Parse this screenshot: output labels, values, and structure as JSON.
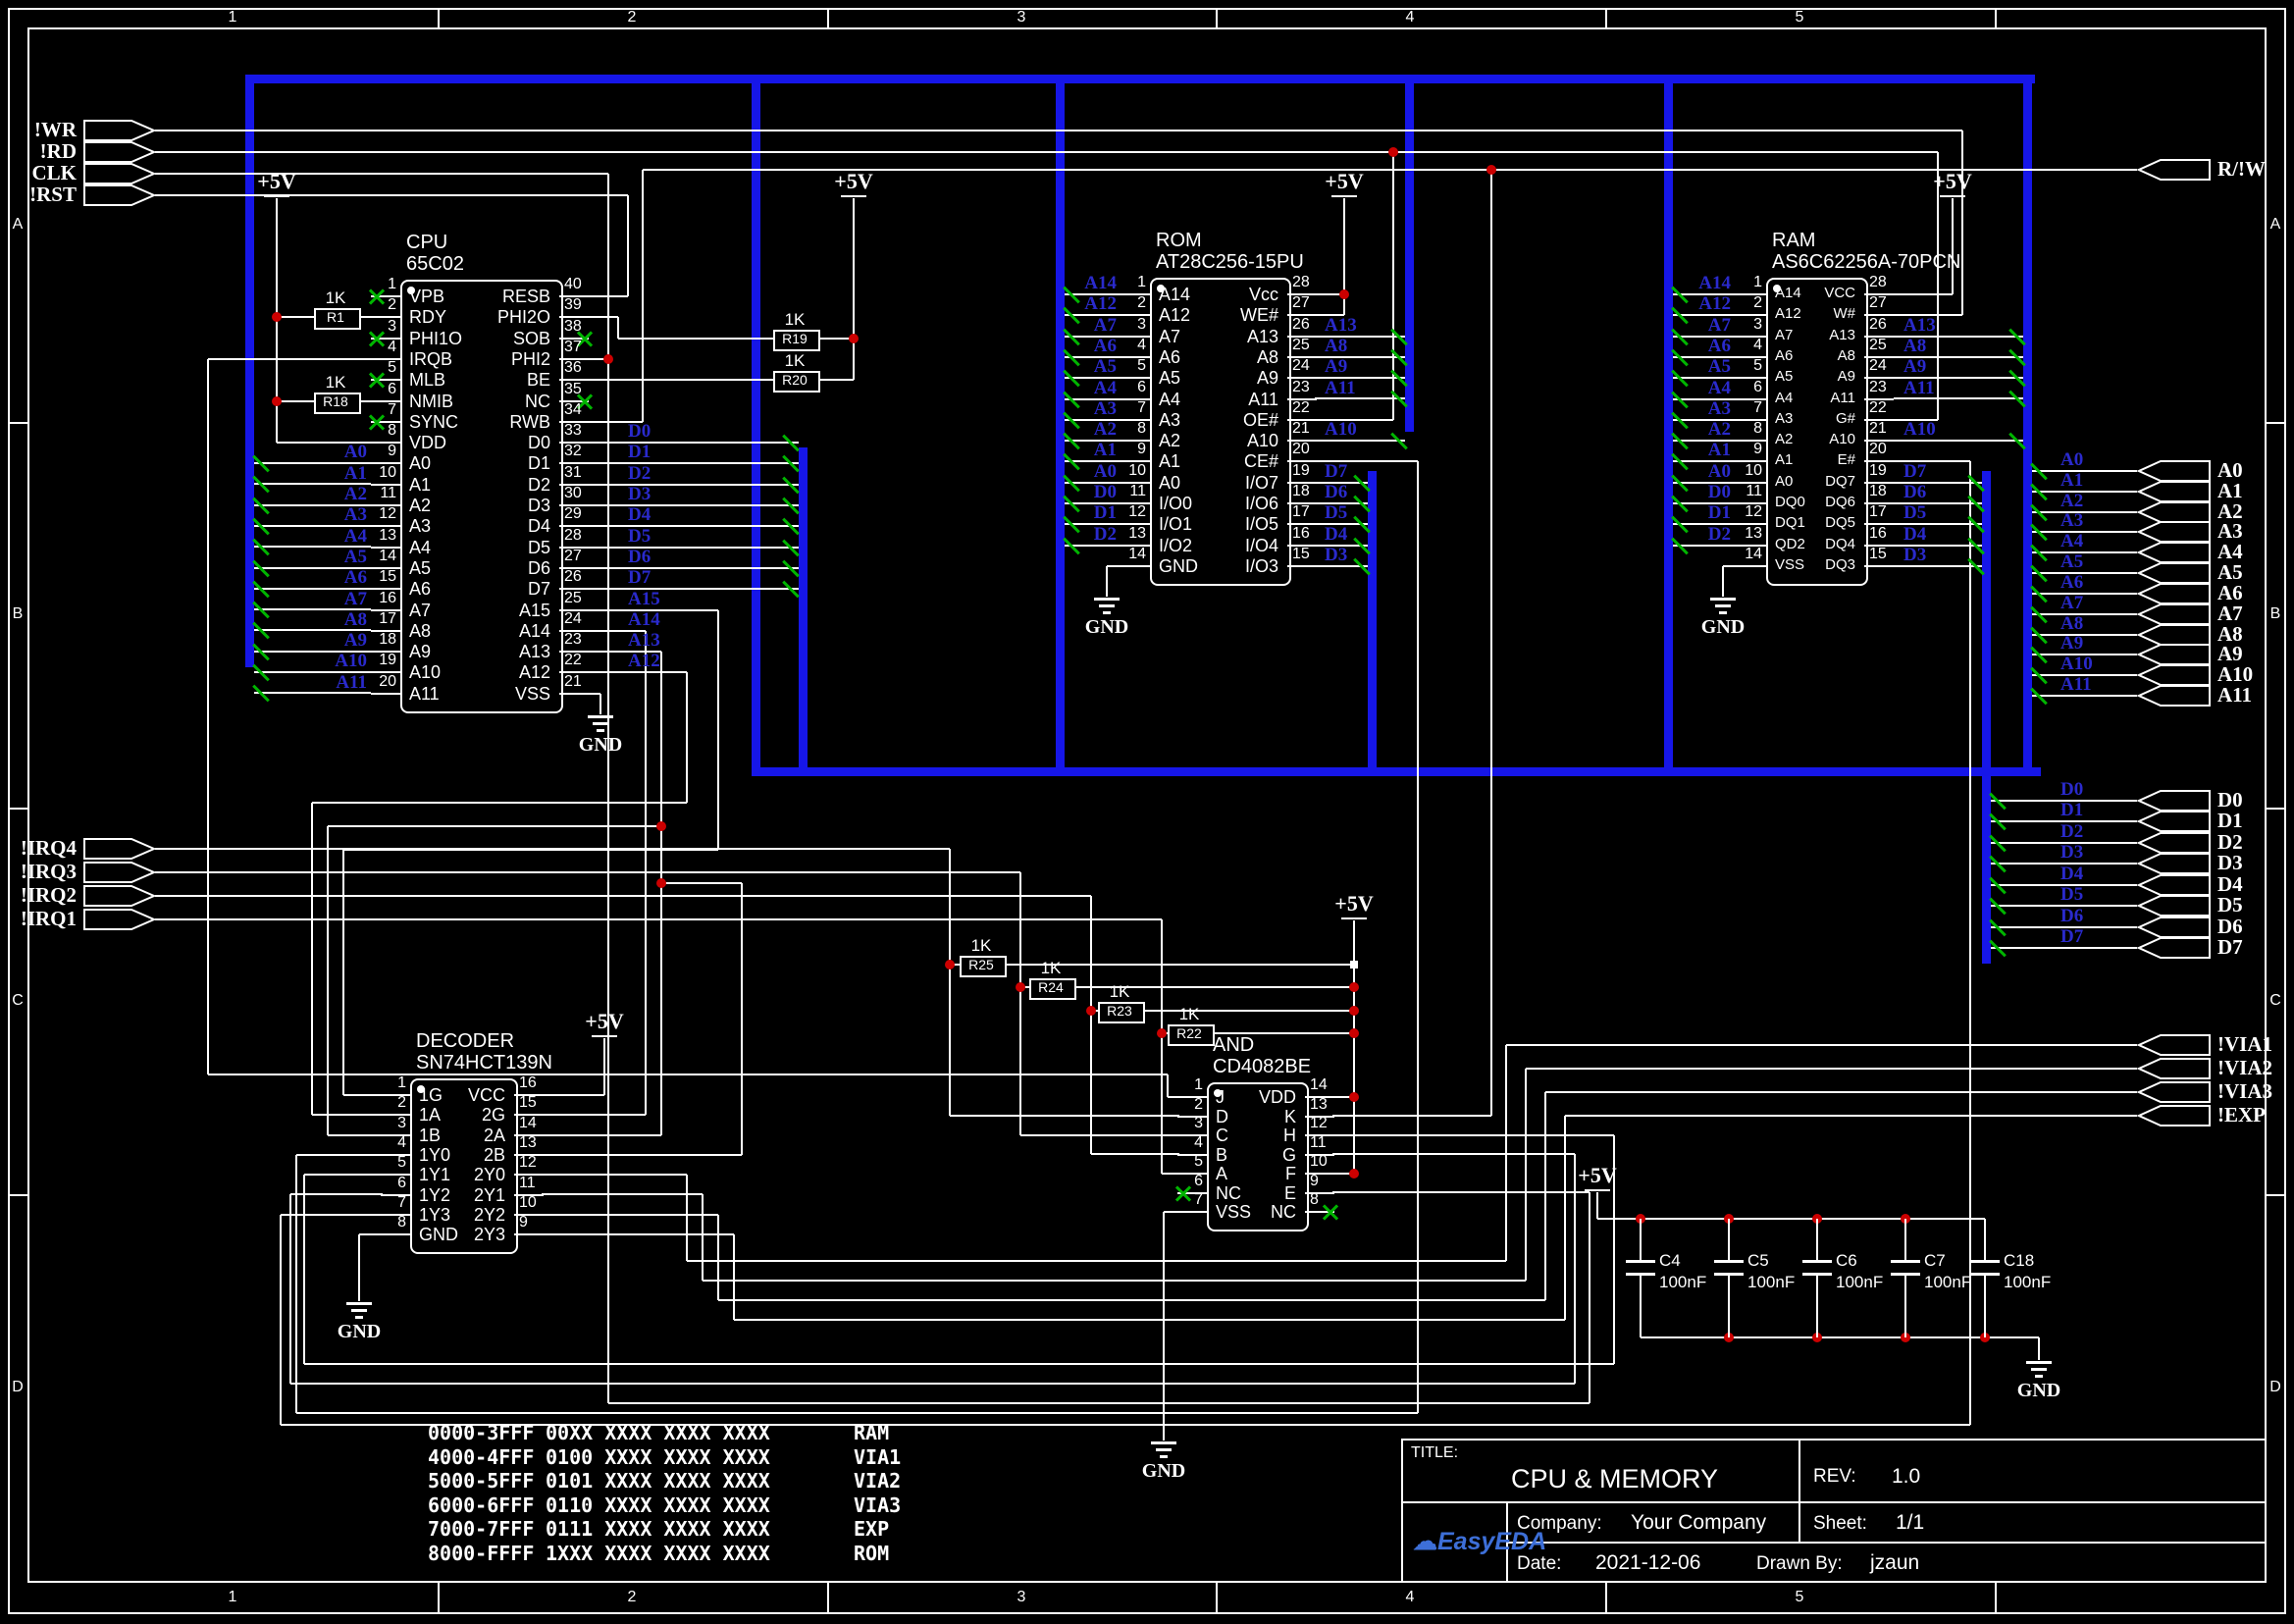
{
  "colors": {
    "bus": "#1616E8",
    "net_label": "#2A2ACC",
    "wire": "#FFFFFF",
    "nc": "#00B400",
    "junction": "#CC0000",
    "logo_blue": "#3D6FD8",
    "background": "#000000"
  },
  "power_labels": {
    "vcc": "+5V",
    "gnd": "GND"
  },
  "ruler": {
    "columns": [
      "1",
      "2",
      "3",
      "4",
      "5"
    ],
    "rows": [
      "A",
      "B",
      "C",
      "D"
    ]
  },
  "ports": {
    "left_top": [
      "!WR",
      "!RD",
      "CLK",
      "!RST"
    ],
    "left_irq": [
      "!IRQ4",
      "!IRQ3",
      "!IRQ2",
      "!IRQ1"
    ],
    "right_rw": "R/!W",
    "right_addr": [
      "A0",
      "A1",
      "A2",
      "A3",
      "A4",
      "A5",
      "A6",
      "A7",
      "A8",
      "A9",
      "A10",
      "A11"
    ],
    "right_data": [
      "D0",
      "D1",
      "D2",
      "D3",
      "D4",
      "D5",
      "D6",
      "D7"
    ],
    "right_sel": [
      "!VIA1",
      "!VIA2",
      "!VIA3",
      "!EXP"
    ]
  },
  "components": {
    "cpu": {
      "ref": "CPU",
      "value": "65C02",
      "left_pins": [
        {
          "num": "1",
          "name": "VPB",
          "nc": true
        },
        {
          "num": "2",
          "name": "RDY"
        },
        {
          "num": "3",
          "name": "PHI1O",
          "nc": true
        },
        {
          "num": "4",
          "name": "IRQB"
        },
        {
          "num": "5",
          "name": "MLB",
          "nc": true
        },
        {
          "num": "6",
          "name": "NMIB"
        },
        {
          "num": "7",
          "name": "SYNC",
          "nc": true
        },
        {
          "num": "8",
          "name": "VDD"
        },
        {
          "num": "9",
          "name": "A0",
          "label": "A0"
        },
        {
          "num": "10",
          "name": "A1",
          "label": "A1"
        },
        {
          "num": "11",
          "name": "A2",
          "label": "A2"
        },
        {
          "num": "12",
          "name": "A3",
          "label": "A3"
        },
        {
          "num": "13",
          "name": "A4",
          "label": "A4"
        },
        {
          "num": "14",
          "name": "A5",
          "label": "A5"
        },
        {
          "num": "15",
          "name": "A6",
          "label": "A6"
        },
        {
          "num": "16",
          "name": "A7",
          "label": "A7"
        },
        {
          "num": "17",
          "name": "A8",
          "label": "A8"
        },
        {
          "num": "18",
          "name": "A9",
          "label": "A9"
        },
        {
          "num": "19",
          "name": "A10",
          "label": "A10"
        },
        {
          "num": "20",
          "name": "A11",
          "label": "A11"
        }
      ],
      "right_pins": [
        {
          "num": "40",
          "name": "RESB"
        },
        {
          "num": "39",
          "name": "PHI2O"
        },
        {
          "num": "38",
          "name": "SOB",
          "nc": true
        },
        {
          "num": "37",
          "name": "PHI2"
        },
        {
          "num": "36",
          "name": "BE"
        },
        {
          "num": "35",
          "name": "NC",
          "nc": true
        },
        {
          "num": "34",
          "name": "RWB"
        },
        {
          "num": "33",
          "name": "D0",
          "label": "D0"
        },
        {
          "num": "32",
          "name": "D1",
          "label": "D1"
        },
        {
          "num": "31",
          "name": "D2",
          "label": "D2"
        },
        {
          "num": "30",
          "name": "D3",
          "label": "D3"
        },
        {
          "num": "29",
          "name": "D4",
          "label": "D4"
        },
        {
          "num": "28",
          "name": "D5",
          "label": "D5"
        },
        {
          "num": "27",
          "name": "D6",
          "label": "D6"
        },
        {
          "num": "26",
          "name": "D7",
          "label": "D7"
        },
        {
          "num": "25",
          "name": "A15",
          "label": "A15"
        },
        {
          "num": "24",
          "name": "A14",
          "label": "A14"
        },
        {
          "num": "23",
          "name": "A13",
          "label": "A13"
        },
        {
          "num": "22",
          "name": "A12",
          "label": "A12"
        },
        {
          "num": "21",
          "name": "VSS"
        }
      ]
    },
    "rom": {
      "ref": "ROM",
      "value": "AT28C256-15PU",
      "left_pins": [
        {
          "num": "1",
          "name": "A14",
          "label": "A14"
        },
        {
          "num": "2",
          "name": "A12",
          "label": "A12"
        },
        {
          "num": "3",
          "name": "A7",
          "label": "A7"
        },
        {
          "num": "4",
          "name": "A6",
          "label": "A6"
        },
        {
          "num": "5",
          "name": "A5",
          "label": "A5"
        },
        {
          "num": "6",
          "name": "A4",
          "label": "A4"
        },
        {
          "num": "7",
          "name": "A3",
          "label": "A3"
        },
        {
          "num": "8",
          "name": "A2",
          "label": "A2"
        },
        {
          "num": "9",
          "name": "A1",
          "label": "A1"
        },
        {
          "num": "10",
          "name": "A0",
          "label": "A0"
        },
        {
          "num": "11",
          "name": "I/O0",
          "label": "D0"
        },
        {
          "num": "12",
          "name": "I/O1",
          "label": "D1"
        },
        {
          "num": "13",
          "name": "I/O2",
          "label": "D2"
        },
        {
          "num": "14",
          "name": "GND"
        }
      ],
      "right_pins": [
        {
          "num": "28",
          "name": "Vcc"
        },
        {
          "num": "27",
          "name": "WE#"
        },
        {
          "num": "26",
          "name": "A13",
          "label": "A13"
        },
        {
          "num": "25",
          "name": "A8",
          "label": "A8"
        },
        {
          "num": "24",
          "name": "A9",
          "label": "A9"
        },
        {
          "num": "23",
          "name": "A11",
          "label": "A11"
        },
        {
          "num": "22",
          "name": "OE#"
        },
        {
          "num": "21",
          "name": "A10",
          "label": "A10"
        },
        {
          "num": "20",
          "name": "CE#"
        },
        {
          "num": "19",
          "name": "I/O7",
          "label": "D7"
        },
        {
          "num": "18",
          "name": "I/O6",
          "label": "D6"
        },
        {
          "num": "17",
          "name": "I/O5",
          "label": "D5"
        },
        {
          "num": "16",
          "name": "I/O4",
          "label": "D4"
        },
        {
          "num": "15",
          "name": "I/O3",
          "label": "D3"
        }
      ]
    },
    "ram": {
      "ref": "RAM",
      "value": "AS6C62256A-70PCN",
      "left_pins": [
        {
          "num": "1",
          "name": "A14",
          "label": "A14"
        },
        {
          "num": "2",
          "name": "A12",
          "label": "A12"
        },
        {
          "num": "3",
          "name": "A7",
          "label": "A7"
        },
        {
          "num": "4",
          "name": "A6",
          "label": "A6"
        },
        {
          "num": "5",
          "name": "A5",
          "label": "A5"
        },
        {
          "num": "6",
          "name": "A4",
          "label": "A4"
        },
        {
          "num": "7",
          "name": "A3",
          "label": "A3"
        },
        {
          "num": "8",
          "name": "A2",
          "label": "A2"
        },
        {
          "num": "9",
          "name": "A1",
          "label": "A1"
        },
        {
          "num": "10",
          "name": "A0",
          "label": "A0"
        },
        {
          "num": "11",
          "name": "DQ0",
          "label": "D0"
        },
        {
          "num": "12",
          "name": "DQ1",
          "label": "D1"
        },
        {
          "num": "13",
          "name": "QD2",
          "label": "D2"
        },
        {
          "num": "14",
          "name": "VSS"
        }
      ],
      "right_pins": [
        {
          "num": "28",
          "name": "VCC"
        },
        {
          "num": "27",
          "name": "W#"
        },
        {
          "num": "26",
          "name": "A13",
          "label": "A13"
        },
        {
          "num": "25",
          "name": "A8",
          "label": "A8"
        },
        {
          "num": "24",
          "name": "A9",
          "label": "A9"
        },
        {
          "num": "23",
          "name": "A11",
          "label": "A11"
        },
        {
          "num": "22",
          "name": "G#"
        },
        {
          "num": "21",
          "name": "A10",
          "label": "A10"
        },
        {
          "num": "20",
          "name": "E#"
        },
        {
          "num": "19",
          "name": "DQ7",
          "label": "D7"
        },
        {
          "num": "18",
          "name": "DQ6",
          "label": "D6"
        },
        {
          "num": "17",
          "name": "DQ5",
          "label": "D5"
        },
        {
          "num": "16",
          "name": "DQ4",
          "label": "D4"
        },
        {
          "num": "15",
          "name": "DQ3",
          "label": "D3"
        }
      ]
    },
    "decoder": {
      "ref": "DECODER",
      "value": "SN74HCT139N",
      "left_pins": [
        {
          "num": "1",
          "name": "1G"
        },
        {
          "num": "2",
          "name": "1A"
        },
        {
          "num": "3",
          "name": "1B"
        },
        {
          "num": "4",
          "name": "1Y0"
        },
        {
          "num": "5",
          "name": "1Y1"
        },
        {
          "num": "6",
          "name": "1Y2"
        },
        {
          "num": "7",
          "name": "1Y3"
        },
        {
          "num": "8",
          "name": "GND"
        }
      ],
      "right_pins": [
        {
          "num": "16",
          "name": "VCC"
        },
        {
          "num": "15",
          "name": "2G"
        },
        {
          "num": "14",
          "name": "2A"
        },
        {
          "num": "13",
          "name": "2B"
        },
        {
          "num": "12",
          "name": "2Y0"
        },
        {
          "num": "11",
          "name": "2Y1"
        },
        {
          "num": "10",
          "name": "2Y2"
        },
        {
          "num": "9",
          "name": "2Y3"
        }
      ]
    },
    "and_gate": {
      "ref": "AND",
      "value": "CD4082BE",
      "left_pins": [
        {
          "num": "1",
          "name": "J"
        },
        {
          "num": "2",
          "name": "D"
        },
        {
          "num": "3",
          "name": "C"
        },
        {
          "num": "4",
          "name": "B"
        },
        {
          "num": "5",
          "name": "A"
        },
        {
          "num": "6",
          "name": "NC",
          "nc": true
        },
        {
          "num": "7",
          "name": "VSS"
        }
      ],
      "right_pins": [
        {
          "num": "14",
          "name": "VDD"
        },
        {
          "num": "13",
          "name": "K"
        },
        {
          "num": "12",
          "name": "H"
        },
        {
          "num": "11",
          "name": "G"
        },
        {
          "num": "10",
          "name": "F"
        },
        {
          "num": "9",
          "name": "E"
        },
        {
          "num": "8",
          "name": "NC",
          "nc": true
        }
      ]
    }
  },
  "resistors": [
    {
      "ref": "R1",
      "value": "1K"
    },
    {
      "ref": "R18",
      "value": "1K"
    },
    {
      "ref": "R19",
      "value": "1K"
    },
    {
      "ref": "R20",
      "value": "1K"
    },
    {
      "ref": "R25",
      "value": "1K"
    },
    {
      "ref": "R24",
      "value": "1K"
    },
    {
      "ref": "R23",
      "value": "1K"
    },
    {
      "ref": "R22",
      "value": "1K"
    }
  ],
  "capacitors": [
    {
      "ref": "C4",
      "value": "100nF"
    },
    {
      "ref": "C5",
      "value": "100nF"
    },
    {
      "ref": "C6",
      "value": "100nF"
    },
    {
      "ref": "C7",
      "value": "100nF"
    },
    {
      "ref": "C18",
      "value": "100nF"
    }
  ],
  "memory_map": [
    {
      "range": "0000-3FFF",
      "bits": "00XX XXXX XXXX XXXX",
      "name": "RAM"
    },
    {
      "range": "4000-4FFF",
      "bits": "0100 XXXX XXXX XXXX",
      "name": "VIA1"
    },
    {
      "range": "5000-5FFF",
      "bits": "0101 XXXX XXXX XXXX",
      "name": "VIA2"
    },
    {
      "range": "6000-6FFF",
      "bits": "0110 XXXX XXXX XXXX",
      "name": "VIA3"
    },
    {
      "range": "7000-7FFF",
      "bits": "0111 XXXX XXXX XXXX",
      "name": "EXP"
    },
    {
      "range": "8000-FFFF",
      "bits": "1XXX XXXX XXXX XXXX",
      "name": "ROM"
    }
  ],
  "title_block": {
    "title_label": "TITLE:",
    "title": "CPU & MEMORY",
    "rev_label": "REV:",
    "rev": "1.0",
    "company_label": "Company:",
    "company": "Your Company",
    "sheet_label": "Sheet:",
    "sheet": "1/1",
    "date_label": "Date:",
    "date": "2021-12-06",
    "drawn_label": "Drawn By:",
    "drawn_by": "jzaun",
    "logo_text": "EasyEDA"
  }
}
